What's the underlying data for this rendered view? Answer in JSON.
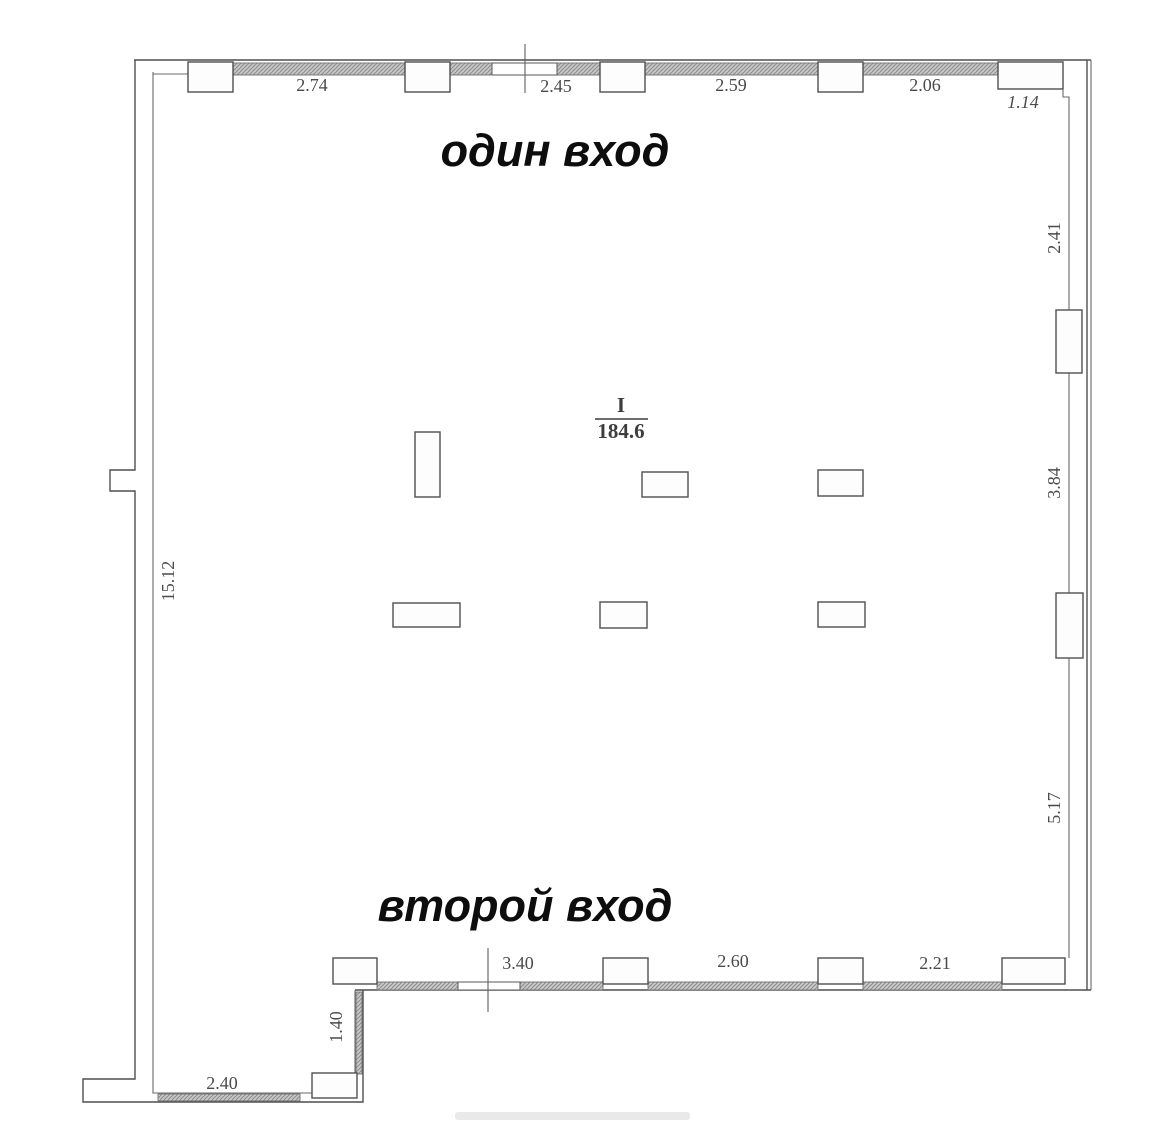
{
  "title": "Floor plan with two entrances",
  "labels": {
    "entrance_one": "один вход",
    "entrance_two": "второй вход"
  },
  "room": {
    "number": "I",
    "area": "184.6"
  },
  "dimensions": {
    "top": [
      "2.74",
      "2.45",
      "2.59",
      "2.06",
      "1.14"
    ],
    "right": [
      "2.41",
      "3.84",
      "5.17"
    ],
    "bottom": [
      "3.40",
      "2.60",
      "2.21"
    ],
    "left": [
      "15.12"
    ],
    "annex_height": "1.40",
    "annex_width": "2.40"
  },
  "colors": {
    "background": "#ffffff",
    "wall_line": "#4f4f4f",
    "hatch_fill": "#c4c4c4",
    "hatch_line": "#8d8d8d",
    "dimension_text": "#4a4a4a",
    "label_text": "#0d0d0d"
  }
}
